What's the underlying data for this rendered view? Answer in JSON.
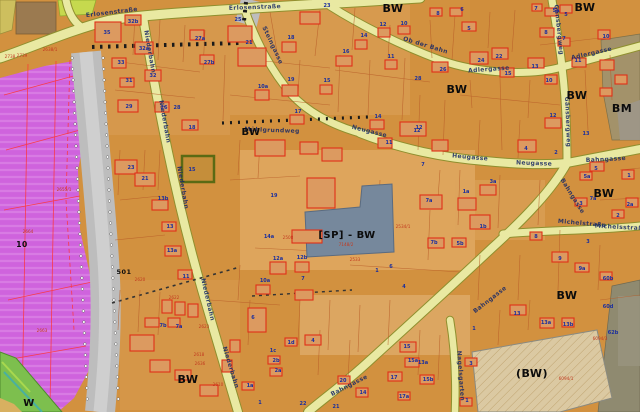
{
  "map": {
    "colors": {
      "base_orange": "#d2913f",
      "light_parcel": "#dfa75f",
      "purple_zone": "#cf63dd",
      "purple_stripe": "#df8fe8",
      "road_yellow": "#e9e9a2",
      "road_edge_olive": "#8f8f2e",
      "railway_gray": "#bdbdbd",
      "lime_zone": "#c6d94e",
      "green_zone": "#7dbf4e",
      "brown_parcel": "#9b7a50",
      "sp_blue_gray": "#76889c",
      "beige_bw_zone": "#dbc9a2",
      "olive_bm_zone": "#a3926a",
      "building_red": "#e03018",
      "parcel_line": "#b85c28",
      "house_number_blue": "#1b2f9e",
      "parcel_number_red": "#c23a20",
      "street_name_blue": "#1a2a66"
    },
    "street_labels": [
      {
        "t": "Erlosenstraße",
        "x": 112,
        "y": 14,
        "r": -7
      },
      {
        "t": "Erlosenstraße",
        "x": 255,
        "y": 9,
        "r": -2
      },
      {
        "t": "Niederbahn",
        "x": 148,
        "y": 52,
        "r": 80
      },
      {
        "t": "Niederbahn",
        "x": 163,
        "y": 122,
        "r": 80
      },
      {
        "t": "Niederbahn",
        "x": 181,
        "y": 188,
        "r": 80
      },
      {
        "t": "Niederbahn",
        "x": 206,
        "y": 300,
        "r": 77
      },
      {
        "t": "Niederbahn",
        "x": 229,
        "y": 368,
        "r": 73
      },
      {
        "t": "Steingasse",
        "x": 271,
        "y": 46,
        "r": 65
      },
      {
        "t": "Ob der Bahn",
        "x": 425,
        "y": 47,
        "r": 17
      },
      {
        "t": "Adlergasse",
        "x": 489,
        "y": 71,
        "r": -4
      },
      {
        "t": "Adlergasse",
        "x": 592,
        "y": 55,
        "r": -13
      },
      {
        "t": "Gänsbergweg",
        "x": 557,
        "y": 30,
        "r": 84
      },
      {
        "t": "Gänsbergweg",
        "x": 566,
        "y": 122,
        "r": 88
      },
      {
        "t": "Neugasse",
        "x": 369,
        "y": 133,
        "r": 14
      },
      {
        "t": "Heugasse",
        "x": 470,
        "y": 159,
        "r": 5
      },
      {
        "t": "Neugasse",
        "x": 534,
        "y": 165,
        "r": 2
      },
      {
        "t": "Bahngasse",
        "x": 606,
        "y": 161,
        "r": -3
      },
      {
        "t": "Bahngasse",
        "x": 571,
        "y": 197,
        "r": 58
      },
      {
        "t": "Bahngasse",
        "x": 491,
        "y": 301,
        "r": -38
      },
      {
        "t": "Bahngasse",
        "x": 350,
        "y": 387,
        "r": -27
      },
      {
        "t": "Michelstraße",
        "x": 582,
        "y": 225,
        "r": 5
      },
      {
        "t": "Michelsstraße",
        "x": 621,
        "y": 229,
        "r": 3
      },
      {
        "t": "Nagelsgarten",
        "x": 459,
        "y": 376,
        "r": 86
      },
      {
        "t": "Mühlgrundweg",
        "x": 272,
        "y": 132,
        "r": 2
      }
    ],
    "zone_labels": [
      {
        "t": "BW",
        "x": 393,
        "y": 12,
        "s": 11
      },
      {
        "t": "BW",
        "x": 585,
        "y": 11,
        "s": 11
      },
      {
        "t": "BW",
        "x": 457,
        "y": 93,
        "s": 11
      },
      {
        "t": "BW",
        "x": 577,
        "y": 99,
        "s": 11
      },
      {
        "t": "BM",
        "x": 622,
        "y": 112,
        "s": 11
      },
      {
        "t": "BW",
        "x": 251,
        "y": 135,
        "s": 10
      },
      {
        "t": "BW",
        "x": 604,
        "y": 197,
        "s": 11
      },
      {
        "t": "BW",
        "x": 567,
        "y": 299,
        "s": 11
      },
      {
        "t": "(BW)",
        "x": 532,
        "y": 377,
        "s": 11
      },
      {
        "t": "BW",
        "x": 188,
        "y": 383,
        "s": 11
      },
      {
        "t": "[SP] - BW",
        "x": 347,
        "y": 238,
        "s": 10
      },
      {
        "t": "W",
        "x": 29,
        "y": 406,
        "s": 10
      },
      {
        "t": "501",
        "x": 124,
        "y": 274,
        "s": 6.5
      },
      {
        "t": "10",
        "x": 22,
        "y": 247,
        "s": 7.5
      }
    ],
    "house_numbers": [
      [
        107,
        34,
        "35"
      ],
      [
        133,
        23,
        "32b"
      ],
      [
        144,
        50,
        "32a"
      ],
      [
        121,
        64,
        "33"
      ],
      [
        153,
        77,
        "32"
      ],
      [
        129,
        82,
        "31"
      ],
      [
        200,
        40,
        "27a"
      ],
      [
        209,
        64,
        "27b"
      ],
      [
        129,
        108,
        "29"
      ],
      [
        164,
        109,
        "26"
      ],
      [
        177,
        109,
        "28"
      ],
      [
        192,
        129,
        "18"
      ],
      [
        238,
        21,
        "25"
      ],
      [
        249,
        44,
        "21"
      ],
      [
        327,
        7,
        "23"
      ],
      [
        291,
        39,
        "18"
      ],
      [
        346,
        53,
        "16"
      ],
      [
        383,
        26,
        "12"
      ],
      [
        404,
        25,
        "10"
      ],
      [
        364,
        37,
        "14"
      ],
      [
        391,
        58,
        "11"
      ],
      [
        291,
        81,
        "19"
      ],
      [
        263,
        88,
        "10a"
      ],
      [
        298,
        113,
        "17"
      ],
      [
        327,
        82,
        "15"
      ],
      [
        378,
        118,
        "14"
      ],
      [
        419,
        129,
        "12"
      ],
      [
        131,
        169,
        "23"
      ],
      [
        145,
        180,
        "21"
      ],
      [
        192,
        171,
        "15"
      ],
      [
        163,
        200,
        "13b"
      ],
      [
        170,
        228,
        "13"
      ],
      [
        172,
        252,
        "13a"
      ],
      [
        186,
        278,
        "11"
      ],
      [
        438,
        15,
        "8"
      ],
      [
        462,
        11,
        "6"
      ],
      [
        469,
        30,
        "5"
      ],
      [
        536,
        10,
        "7"
      ],
      [
        556,
        12,
        "5a"
      ],
      [
        566,
        16,
        "5"
      ],
      [
        546,
        34,
        "8"
      ],
      [
        564,
        40,
        "7"
      ],
      [
        606,
        38,
        "10"
      ],
      [
        481,
        62,
        "24"
      ],
      [
        499,
        58,
        "22"
      ],
      [
        443,
        71,
        "26"
      ],
      [
        508,
        75,
        "15"
      ],
      [
        535,
        68,
        "13"
      ],
      [
        578,
        62,
        "11"
      ],
      [
        549,
        82,
        "10"
      ],
      [
        553,
        117,
        "12"
      ],
      [
        586,
        135,
        "13"
      ],
      [
        418,
        80,
        "28"
      ],
      [
        417,
        132,
        "12"
      ],
      [
        389,
        144,
        "11"
      ],
      [
        423,
        166,
        "7"
      ],
      [
        429,
        202,
        "7a"
      ],
      [
        493,
        183,
        "3a"
      ],
      [
        466,
        193,
        "1a"
      ],
      [
        483,
        228,
        "1b"
      ],
      [
        526,
        150,
        "4"
      ],
      [
        556,
        154,
        "2"
      ],
      [
        587,
        178,
        "5a"
      ],
      [
        596,
        170,
        "5"
      ],
      [
        593,
        200,
        "7a"
      ],
      [
        629,
        177,
        "1"
      ],
      [
        630,
        206,
        "2a"
      ],
      [
        618,
        217,
        "2"
      ],
      [
        581,
        205,
        "3"
      ],
      [
        536,
        238,
        "8"
      ],
      [
        588,
        243,
        "3"
      ],
      [
        560,
        260,
        "9"
      ],
      [
        582,
        270,
        "9a"
      ],
      [
        608,
        280,
        "60b"
      ],
      [
        274,
        197,
        "19"
      ],
      [
        269,
        238,
        "14a"
      ],
      [
        278,
        260,
        "12a"
      ],
      [
        302,
        259,
        "12b"
      ],
      [
        303,
        280,
        "7"
      ],
      [
        265,
        282,
        "10a"
      ],
      [
        377,
        272,
        "1"
      ],
      [
        391,
        268,
        "6"
      ],
      [
        404,
        288,
        "4"
      ],
      [
        434,
        244,
        "7b"
      ],
      [
        460,
        245,
        "5b"
      ],
      [
        253,
        319,
        "6"
      ],
      [
        313,
        342,
        "4"
      ],
      [
        291,
        344,
        "1d"
      ],
      [
        273,
        352,
        "1c"
      ],
      [
        276,
        362,
        "2b"
      ],
      [
        278,
        372,
        "2a"
      ],
      [
        250,
        387,
        "1a"
      ],
      [
        260,
        404,
        "1"
      ],
      [
        303,
        405,
        "22"
      ],
      [
        336,
        408,
        "21"
      ],
      [
        163,
        327,
        "7b"
      ],
      [
        179,
        328,
        "7a"
      ],
      [
        517,
        315,
        "13"
      ],
      [
        546,
        324,
        "13a"
      ],
      [
        568,
        326,
        "13b"
      ],
      [
        608,
        308,
        "60d"
      ],
      [
        613,
        334,
        "62b"
      ],
      [
        474,
        330,
        "1"
      ],
      [
        407,
        348,
        "15"
      ],
      [
        413,
        362,
        "15a"
      ],
      [
        428,
        381,
        "15b"
      ],
      [
        394,
        379,
        "17"
      ],
      [
        404,
        398,
        "17a"
      ],
      [
        363,
        394,
        "14"
      ],
      [
        343,
        382,
        "20"
      ],
      [
        423,
        364,
        "13a"
      ],
      [
        471,
        365,
        "3"
      ],
      [
        467,
        402,
        "1"
      ]
    ],
    "parcel_numbers": [
      [
        10,
        58,
        "2738"
      ],
      [
        22,
        57,
        "2739"
      ],
      [
        50,
        51,
        "2638/1"
      ],
      [
        64,
        191,
        "2655/1"
      ],
      [
        28,
        233,
        "2664"
      ],
      [
        42,
        332,
        "2663"
      ],
      [
        140,
        281,
        "2620"
      ],
      [
        174,
        299,
        "2622"
      ],
      [
        204,
        328,
        "2623"
      ],
      [
        200,
        365,
        "2636"
      ],
      [
        218,
        386,
        "2610"
      ],
      [
        199,
        356,
        "2618"
      ],
      [
        288,
        239,
        "2508"
      ],
      [
        355,
        261,
        "2533"
      ],
      [
        403,
        228,
        "2534/1"
      ],
      [
        346,
        246,
        "7148/2"
      ],
      [
        566,
        380,
        "6094/1"
      ],
      [
        600,
        340,
        "6094/3"
      ]
    ]
  }
}
